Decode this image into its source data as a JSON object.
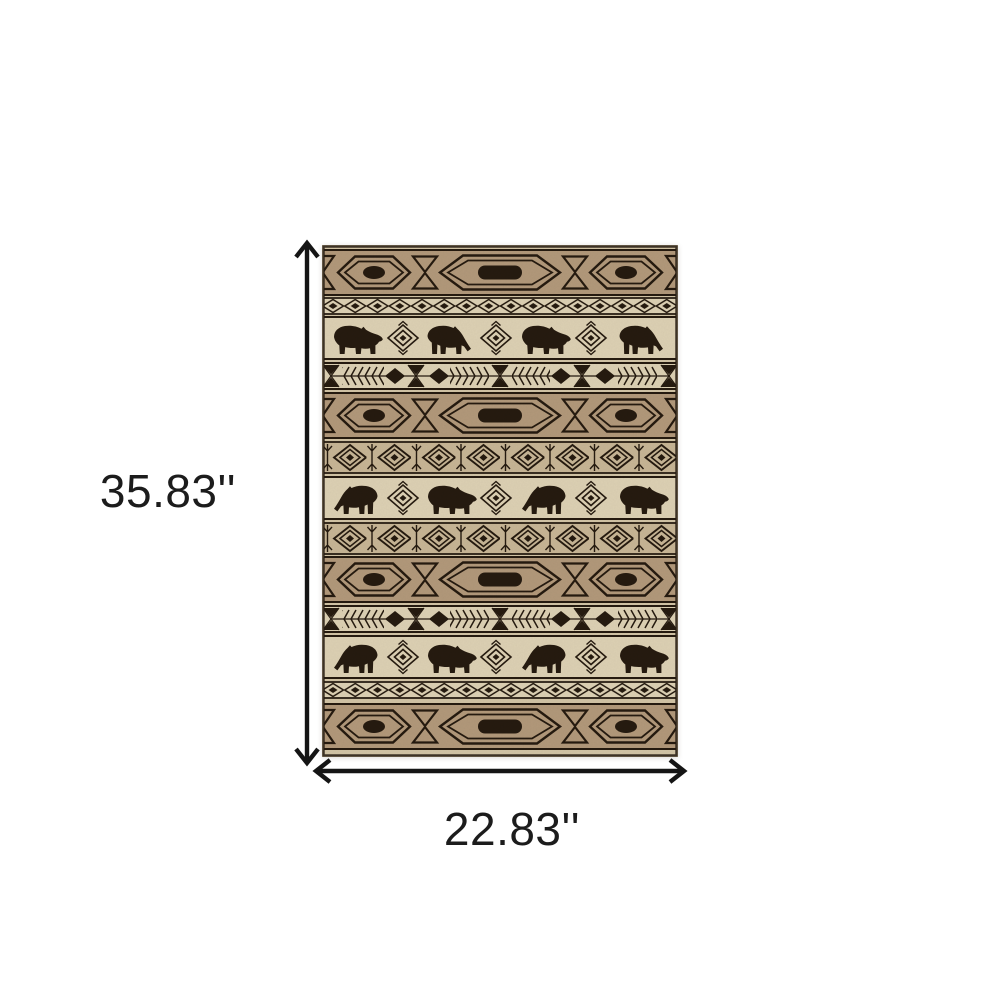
{
  "page": {
    "background_color": "#ffffff",
    "type": "product-dimension-image"
  },
  "rug": {
    "description": "Beige ivory and black area rug with southwestern lodge pattern of bear silhouettes, hexagon medallions, diamond eyes and arrow-feather stripes",
    "colors": {
      "ink": "#261b10",
      "band_tan": "#b79e80",
      "base_tan": "#d8cbad",
      "cream": "#e3d8bc",
      "eye_tan": "#cdbc9c"
    },
    "bands": [
      "hexagon-medallion-stripe",
      "small-diamond-stripe",
      "bear-stripe",
      "arrow-feather-stripe",
      "hexagon-medallion-stripe",
      "diamond-eye-stripe",
      "bear-stripe",
      "diamond-eye-stripe",
      "hexagon-medallion-stripe",
      "arrow-feather-stripe",
      "bear-stripe",
      "small-diamond-stripe",
      "hexagon-medallion-stripe"
    ]
  },
  "dimensions": {
    "height": {
      "label": "35.83''"
    },
    "width": {
      "label": "22.83''"
    },
    "arrow_color": "#151515",
    "text_color": "#1c1c1c"
  }
}
